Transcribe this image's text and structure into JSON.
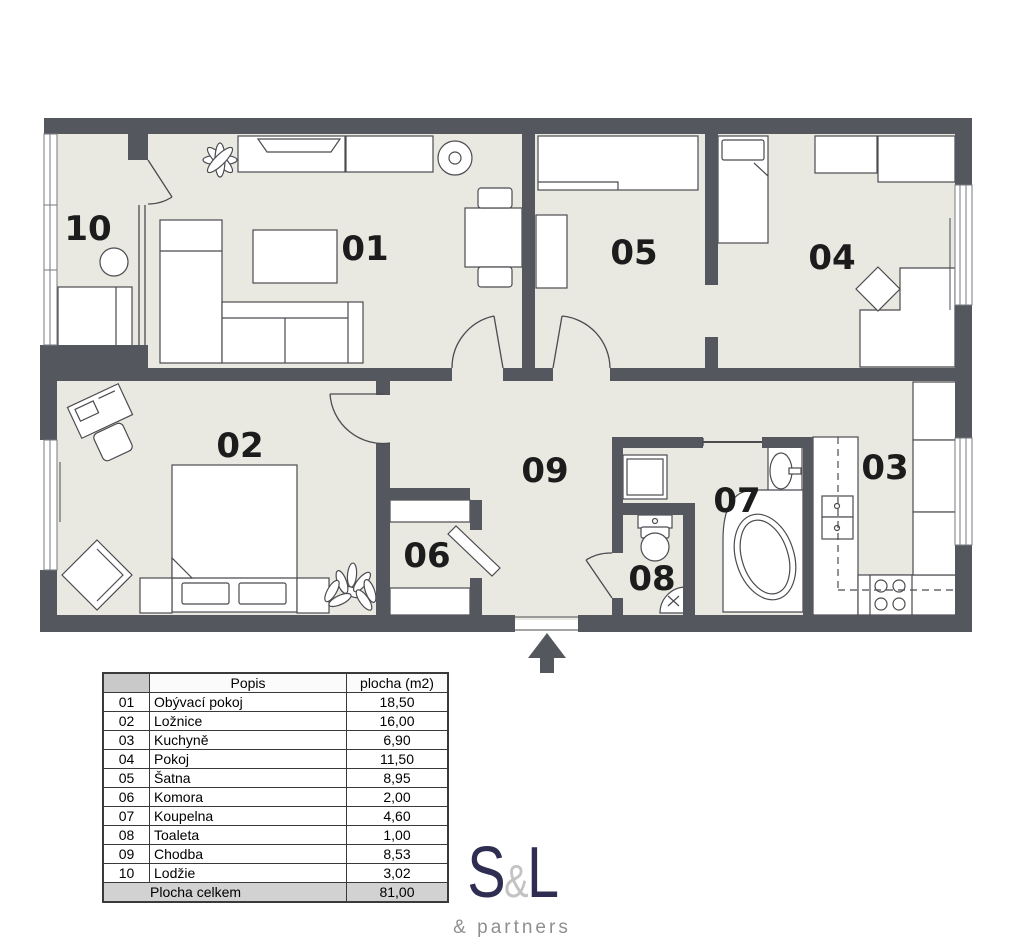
{
  "plan": {
    "entrance_arrow": "up",
    "colors": {
      "wall": "#54575e",
      "floor": "#e9e9e1"
    },
    "fixtures": [
      "sofa",
      "coffee-table",
      "tv-sideboard",
      "speaker",
      "dining-table",
      "plant",
      "loggia-table",
      "loggia-bench",
      "wardrobe",
      "single-bed",
      "desk",
      "desk-chair",
      "double-bed",
      "nightstand",
      "armchair",
      "shelf",
      "door",
      "toilet",
      "corner-basin",
      "washing-machine",
      "washbasin",
      "corner-bathtub",
      "kitchen-counter",
      "stove",
      "fridge-cabinets"
    ]
  },
  "legend": {
    "headers": {
      "num": "",
      "popis": "Popis",
      "plocha": "plocha (m2)"
    },
    "rows": [
      {
        "num": "01",
        "name": "Obývací pokoj",
        "area": "18,50"
      },
      {
        "num": "02",
        "name": "Ložnice",
        "area": "16,00"
      },
      {
        "num": "03",
        "name": "Kuchyně",
        "area": "6,90"
      },
      {
        "num": "04",
        "name": "Pokoj",
        "area": "11,50"
      },
      {
        "num": "05",
        "name": "Šatna",
        "area": "8,95"
      },
      {
        "num": "06",
        "name": "Komora",
        "area": "2,00"
      },
      {
        "num": "07",
        "name": "Koupelna",
        "area": "4,60"
      },
      {
        "num": "08",
        "name": "Toaleta",
        "area": "1,00"
      },
      {
        "num": "09",
        "name": "Chodba",
        "area": "8,53"
      },
      {
        "num": "10",
        "name": "Lodžie",
        "area": "3,02"
      }
    ],
    "total_label": "Plocha celkem",
    "total_value": "81,00"
  },
  "logo": {
    "s": "S",
    "amp": "&",
    "l": "L",
    "tagline": "& partners",
    "navy": "#2f2d52",
    "gray": "#c3c3c3"
  }
}
